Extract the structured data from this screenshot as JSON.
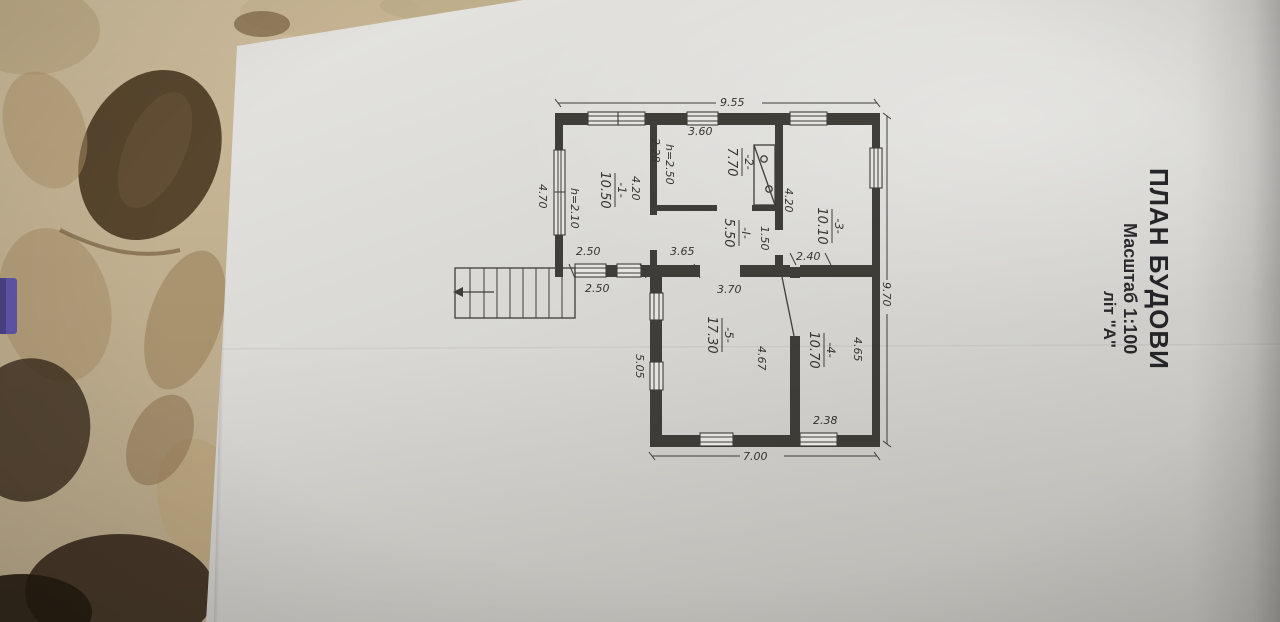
{
  "document": {
    "title": "ПЛАН БУДОВИ",
    "scale": "Масштаб 1:100",
    "letter": "літ \"А\""
  },
  "plan": {
    "rooms": [
      {
        "number": "-1-",
        "area": "10.50",
        "height": "h=2.10"
      },
      {
        "number": "-2-",
        "area": "7.70",
        "height": "h=2.50"
      },
      {
        "number": "-3-",
        "area": "10.10"
      },
      {
        "number": "-4-",
        "area": "10.70"
      },
      {
        "number": "-5-",
        "area": "17.30"
      },
      {
        "number": "-I-",
        "area": "5.50"
      }
    ],
    "dims": {
      "overall_left": "9.55",
      "overall_top": "9.70",
      "overall_right": "7.00",
      "r1_bottom": "4.70",
      "r1_depth": "4.20",
      "r2_len": "3.60",
      "r2_width": "2.28",
      "r3_wall": "4.20",
      "r3_opening": "1.50",
      "r3_width": "2.40",
      "r4_len": "4.65",
      "r4_width": "2.38",
      "r5_len": "4.67",
      "r5_outside": "5.05",
      "r5_wall": "3.70",
      "vest_wall": "3.65",
      "corridor_inner": "2.50",
      "corridor_outer": "2.50"
    }
  },
  "colors": {
    "paper": "#d8d7d3",
    "cloth": "#bfae8e",
    "ink": "#34322d",
    "purple_object": "#5f55a8"
  }
}
